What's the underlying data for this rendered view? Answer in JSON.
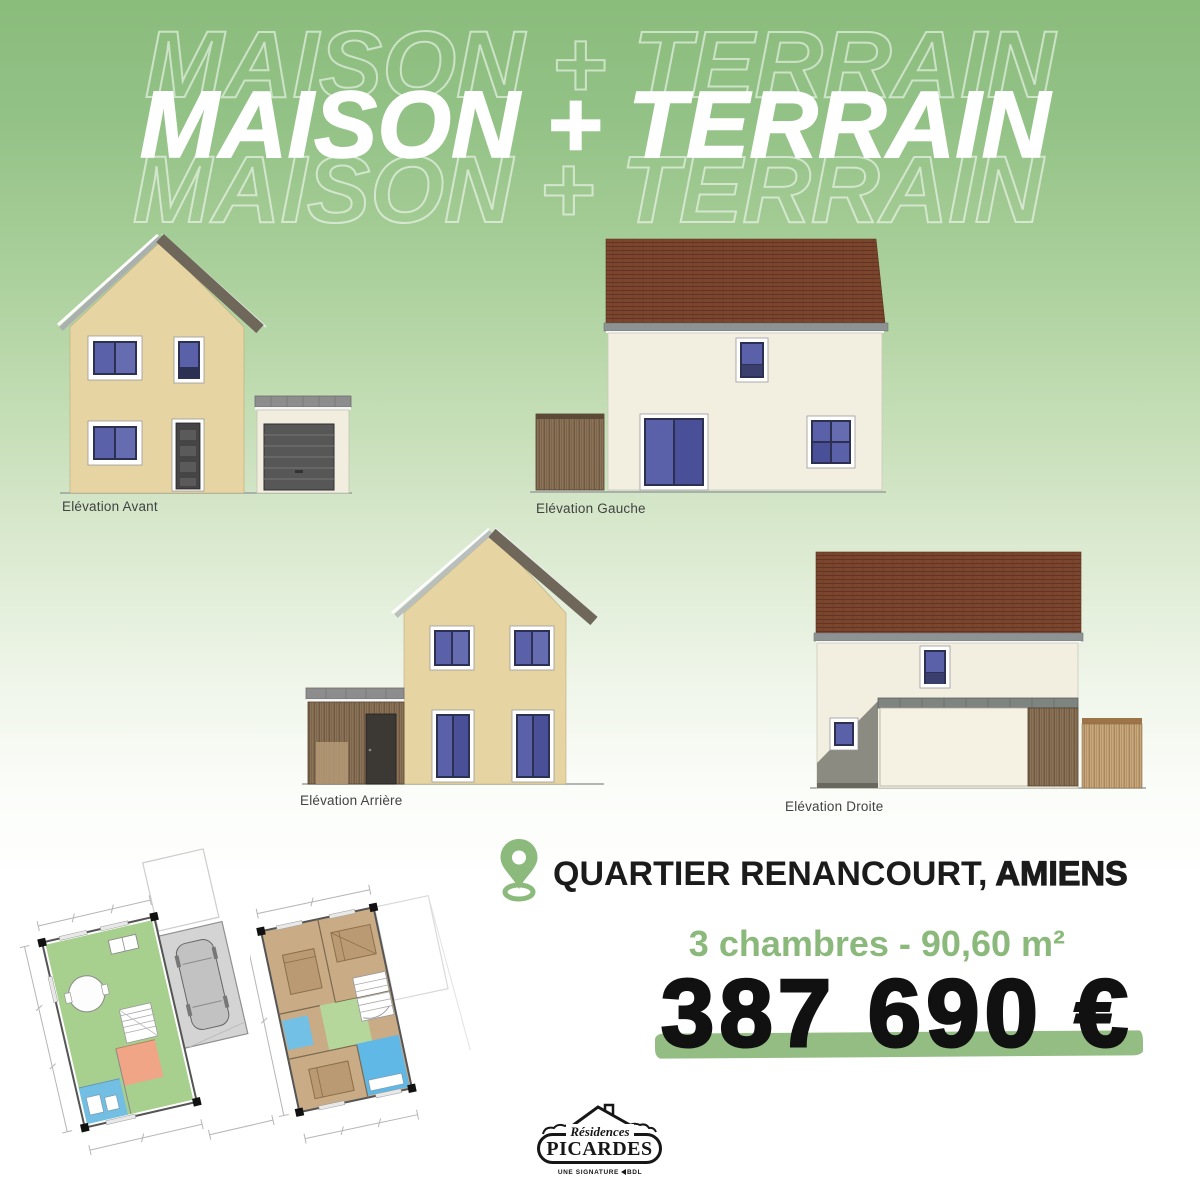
{
  "title": {
    "main": "MAISON + TERRAIN",
    "ghost_top": "MAISON + TERRAIN",
    "ghost_bottom": "MAISON + TERRAIN"
  },
  "elevations": [
    {
      "label": "Elévation Avant"
    },
    {
      "label": "Elévation Gauche"
    },
    {
      "label": "Elévation Arrière"
    },
    {
      "label": "Elévation Droite"
    }
  ],
  "location": {
    "quartier": "QUARTIER RENANCOURT,",
    "city": "AMIENS"
  },
  "specs": {
    "text": "3 chambres - 90,60 m²"
  },
  "price": {
    "text": "387 690 €"
  },
  "logo": {
    "script": "Résidences",
    "name": "PICARDES",
    "tagline_prefix": "UNE SIGNATURE",
    "tagline_brand": "BDL"
  },
  "colors": {
    "background_green": "#8cbd7e",
    "accent_green": "#8bb97b",
    "price_underline_green": "#94bd83",
    "text_black": "#111111",
    "roof_tile_brown": "#7c452d",
    "wall_tan": "#e6d5a2",
    "wall_cream": "#f2efe1",
    "window_blue": "#5a61a8",
    "wood_brown": "#8c7257",
    "plan_living_green": "#a7cf8e",
    "plan_bath_blue": "#6fc0e8",
    "plan_entry_salmon": "#f0a586",
    "plan_bedroom_tan": "#c9ab85"
  }
}
